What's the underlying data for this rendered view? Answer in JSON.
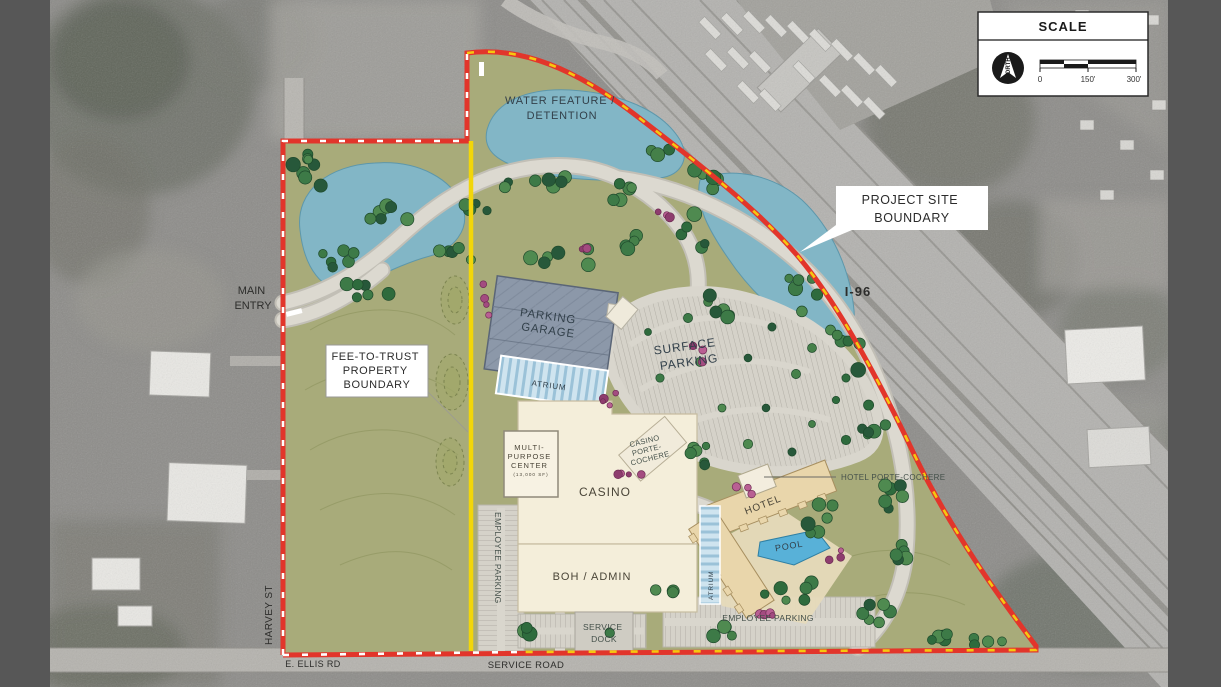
{
  "scale_panel": {
    "title": "SCALE",
    "north": "NORTH",
    "tick0": "0",
    "tick150": "150'",
    "tick300": "300'"
  },
  "annotations": {
    "water_feature_line1": "WATER FEATURE /",
    "water_feature_line2": "DETENTION",
    "project_site_line1": "PROJECT SITE",
    "project_site_line2": "BOUNDARY",
    "i96": "I-96",
    "main_entry_line1": "MAIN",
    "main_entry_line2": "ENTRY",
    "harvey_st": "HARVEY ST",
    "fee_line1": "FEE-TO-TRUST",
    "fee_line2": "PROPERTY",
    "fee_line3": "BOUNDARY",
    "e_ellis_rd": "E. ELLIS RD",
    "service_road": "SERVICE ROAD"
  },
  "site_labels": {
    "parking_garage_line1": "PARKING",
    "parking_garage_line2": "GARAGE",
    "atrium_garage": "ATRIUM",
    "surface_parking_line1": "SURFACE",
    "surface_parking_line2": "PARKING",
    "casino_pc_line1": "CASINO",
    "casino_pc_line2": "PORTE-",
    "casino_pc_line3": "COCHERE",
    "hotel_pc": "HOTEL PORTE-COCHERE",
    "hotel": "HOTEL",
    "pool": "POOL",
    "atrium_hotel": "ATRIUM",
    "mpc_line1": "MULTI-",
    "mpc_line2": "PURPOSE",
    "mpc_line3": "CENTER",
    "mpc_line4": "(13,000 SF)",
    "casino": "CASINO",
    "boh": "BOH / ADMIN",
    "employee_parking_west": "EMPLOYEE PARKING",
    "employee_parking_south": "EMPLOYEE PARKING",
    "service_dock_line1": "SERVICE",
    "service_dock_line2": "DOCK"
  },
  "colors": {
    "boundary_red": "#e2352b",
    "dash_yellow": "#f6c70f",
    "dash_white": "#ffffff",
    "fee_yellow": "#f2d60a",
    "water": "#82b6c6",
    "lawn": "#a8ab7a",
    "garage": "#8c98a9",
    "atrium_glass": "#cfe4ef",
    "building_cream": "#f4eeda",
    "hotel_tan": "#e9d6ab",
    "pool_blue": "#58b1d8",
    "road": "#dcd9d0",
    "aerial_gray": "#8e8d8a",
    "label_dark": "#33414b"
  }
}
